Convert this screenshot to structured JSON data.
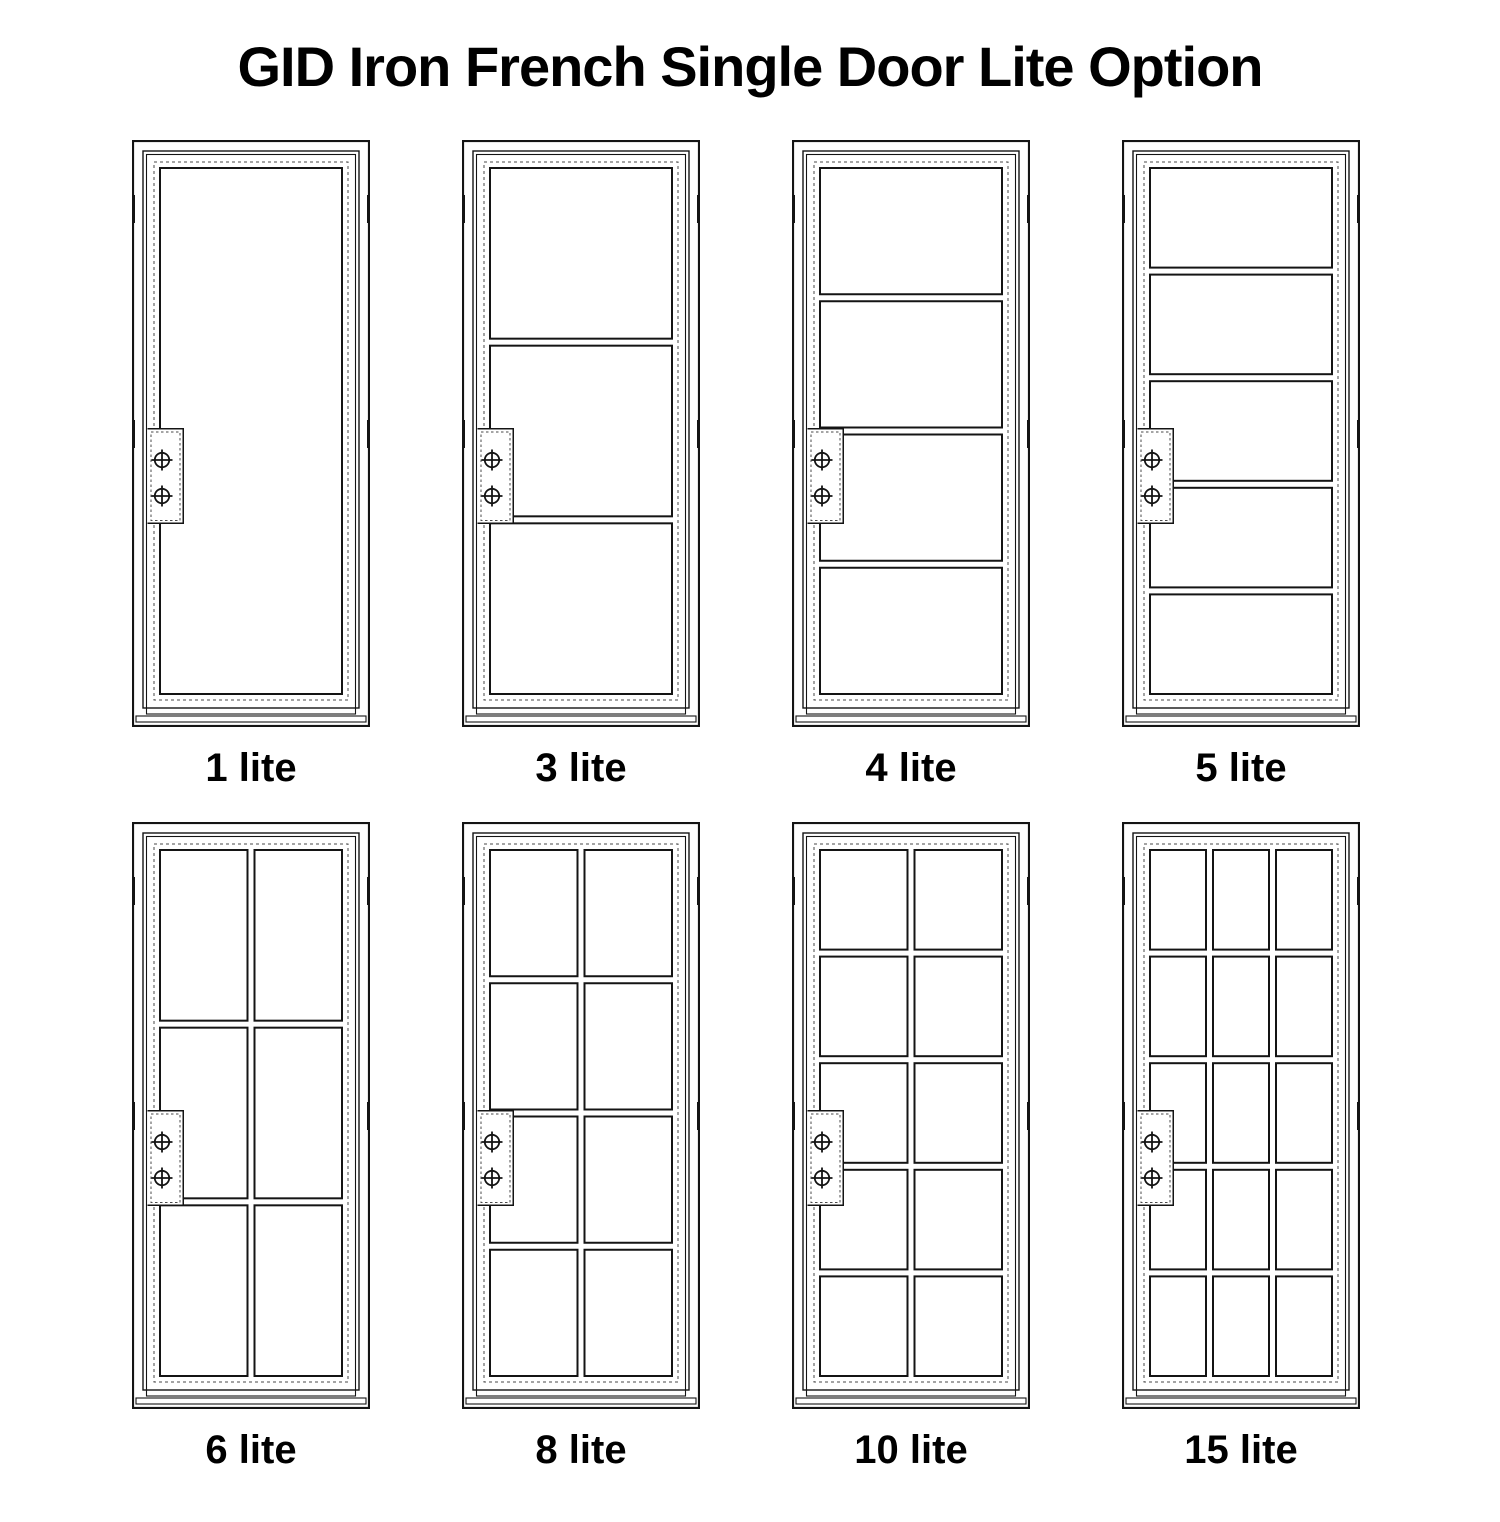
{
  "title": "GID Iron French Single Door Lite Option",
  "doors": [
    {
      "label": "1 lite",
      "lites": 1,
      "grid": {
        "cols": 1,
        "rows": 1
      }
    },
    {
      "label": "3 lite",
      "lites": 3,
      "grid": {
        "cols": 1,
        "rows": 3
      }
    },
    {
      "label": "4 lite",
      "lites": 4,
      "grid": {
        "cols": 1,
        "rows": 4
      }
    },
    {
      "label": "5 lite",
      "lites": 5,
      "grid": {
        "cols": 1,
        "rows": 5
      }
    },
    {
      "label": "6 lite",
      "lites": 6,
      "grid": {
        "cols": 2,
        "rows": 3
      }
    },
    {
      "label": "8 lite",
      "lites": 8,
      "grid": {
        "cols": 2,
        "rows": 4
      }
    },
    {
      "label": "10 lite",
      "lites": 10,
      "grid": {
        "cols": 2,
        "rows": 5
      }
    },
    {
      "label": "15 lite",
      "lites": 15,
      "grid": {
        "cols": 3,
        "rows": 5
      }
    }
  ],
  "door_features": {
    "lock_plate_screws": 2,
    "hinge_marks_per_side": 2
  },
  "colors": {
    "line": "#141414",
    "dashed_line": "#4a4a4a",
    "background": "#ffffff",
    "text": "#000000"
  }
}
